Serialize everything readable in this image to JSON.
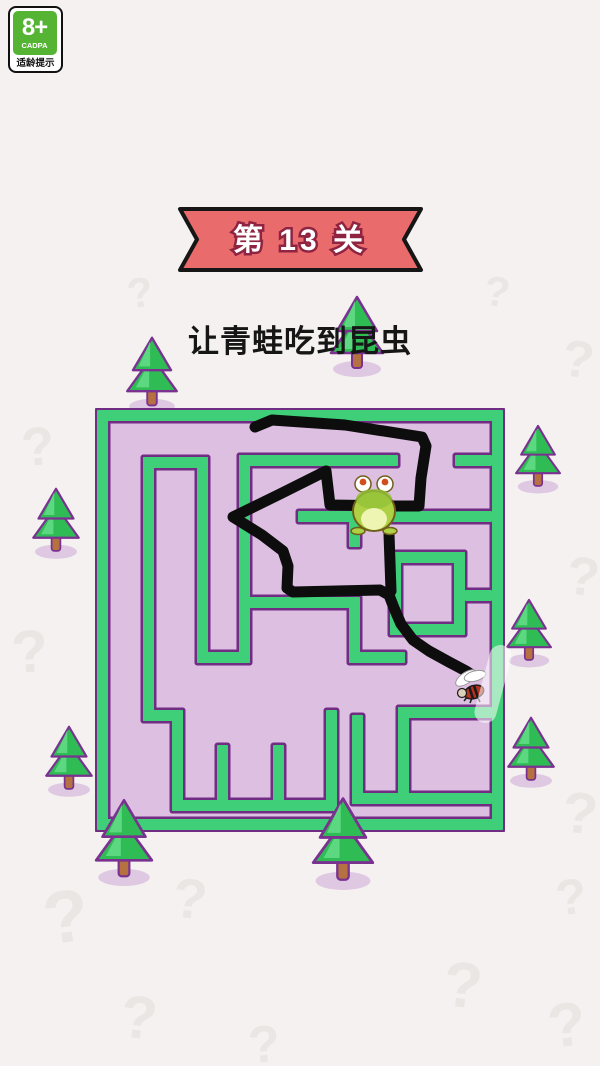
{
  "page": {
    "bg": "#f4f1f0"
  },
  "age_badge": {
    "rating": "8+",
    "org": "CADPA",
    "label": "适龄提示",
    "green": "#55b434"
  },
  "banner": {
    "text": "第 13 关",
    "fill": "#ea6b6b",
    "outline": "#161616",
    "text_color": "#ffffff",
    "text_outline": "#8e2342"
  },
  "subtitle": {
    "text": "让青蛙吃到昆虫",
    "color": "#161616"
  },
  "colors": {
    "wall_green": "#3ecf78",
    "wall_outline": "#712d83",
    "floor": "#d6b0dc",
    "floor_light": "#ddbfe2",
    "tree_green": "#2fbc55",
    "tree_light": "#64de88",
    "tree_outline": "#7a3190",
    "trunk": "#b5713f",
    "tree_shadow": "#cfadd8",
    "qmark": "#e9e6e3"
  },
  "background": {
    "qmark_char": "?",
    "qmarks": [
      [
        140,
        293,
        42,
        -8
      ],
      [
        497,
        292,
        42,
        8
      ],
      [
        38,
        447,
        54,
        -6
      ],
      [
        578,
        360,
        52,
        8
      ],
      [
        30,
        652,
        60,
        -5
      ],
      [
        583,
        577,
        54,
        7
      ],
      [
        580,
        814,
        58,
        5
      ],
      [
        66,
        917,
        74,
        -8
      ],
      [
        190,
        899,
        56,
        6
      ],
      [
        463,
        985,
        64,
        5
      ],
      [
        571,
        897,
        50,
        -6
      ],
      [
        139,
        1018,
        60,
        6
      ],
      [
        567,
        1026,
        62,
        -7
      ],
      [
        264,
        1045,
        52,
        -4
      ]
    ]
  },
  "trees": {
    "back": [
      [
        118,
        334,
        68,
        80
      ],
      [
        325,
        293,
        64,
        84
      ],
      [
        28,
        484,
        56,
        76
      ],
      [
        511,
        421,
        54,
        74
      ],
      [
        502,
        594,
        54,
        76
      ],
      [
        41,
        720,
        56,
        80
      ],
      [
        503,
        712,
        56,
        78
      ]
    ],
    "front": [
      [
        86,
        796,
        76,
        90
      ],
      [
        304,
        794,
        78,
        96
      ]
    ]
  },
  "maze": {
    "x": 95,
    "y": 408,
    "w": 410,
    "h": 424,
    "walls": [
      [
        2,
        2,
        406,
        11
      ],
      [
        2,
        2,
        11,
        420
      ],
      [
        397,
        2,
        11,
        420
      ],
      [
        2,
        411,
        406,
        11
      ],
      [
        48,
        49,
        65,
        11
      ],
      [
        48,
        49,
        11,
        264
      ],
      [
        48,
        302,
        40,
        11
      ],
      [
        77,
        302,
        11,
        101
      ],
      [
        77,
        392,
        165,
        11
      ],
      [
        122,
        337,
        11,
        66
      ],
      [
        178,
        337,
        11,
        66
      ],
      [
        231,
        302,
        11,
        101
      ],
      [
        102,
        49,
        11,
        206
      ],
      [
        102,
        244,
        53,
        11
      ],
      [
        144,
        47,
        11,
        208
      ],
      [
        144,
        47,
        159,
        11
      ],
      [
        360,
        47,
        37,
        11
      ],
      [
        203,
        103,
        194,
        11
      ],
      [
        254,
        114,
        11,
        25
      ],
      [
        144,
        189,
        116,
        11
      ],
      [
        254,
        189,
        11,
        66
      ],
      [
        254,
        244,
        56,
        11
      ],
      [
        295,
        144,
        75,
        11
      ],
      [
        295,
        216,
        75,
        11
      ],
      [
        295,
        144,
        11,
        83
      ],
      [
        359,
        144,
        11,
        83
      ],
      [
        370,
        182,
        27,
        11
      ],
      [
        303,
        299,
        11,
        96
      ],
      [
        303,
        299,
        94,
        11
      ],
      [
        257,
        385,
        140,
        11
      ],
      [
        257,
        307,
        11,
        89
      ]
    ],
    "line": {
      "color": "#0d0d0d",
      "width": 11,
      "main": [
        [
          160,
          19
        ],
        [
          177,
          12
        ],
        [
          250,
          17
        ],
        [
          327,
          29
        ],
        [
          331,
          38
        ],
        [
          326,
          70
        ],
        [
          324,
          98
        ],
        [
          300,
          98
        ],
        [
          235,
          97
        ],
        [
          231,
          63
        ],
        [
          185,
          86
        ],
        [
          138,
          109
        ],
        [
          167,
          127
        ],
        [
          188,
          143
        ],
        [
          193,
          158
        ],
        [
          192,
          180
        ],
        [
          198,
          184
        ],
        [
          285,
          182
        ],
        [
          294,
          187
        ],
        [
          299,
          200
        ],
        [
          306,
          216
        ],
        [
          318,
          232
        ],
        [
          334,
          243
        ],
        [
          354,
          254
        ],
        [
          371,
          263
        ],
        [
          377,
          267
        ]
      ],
      "drop": [
        [
          294,
          126
        ],
        [
          296,
          183
        ]
      ]
    },
    "frog": {
      "x": 255,
      "y": 66,
      "w": 48,
      "h": 60,
      "body": "#aed045",
      "body_dark": "#93c238",
      "belly": "#eef5b2",
      "outline": "#6f5f19",
      "eye": "#ffffff",
      "pupil": "#cf4f1f"
    },
    "fly": {
      "x": 357,
      "y": 256,
      "w": 40,
      "h": 42,
      "wing": "#ffffff",
      "body": "#b5321e",
      "stripe": "#1a1a1a",
      "head": "#ddd0b8"
    }
  }
}
